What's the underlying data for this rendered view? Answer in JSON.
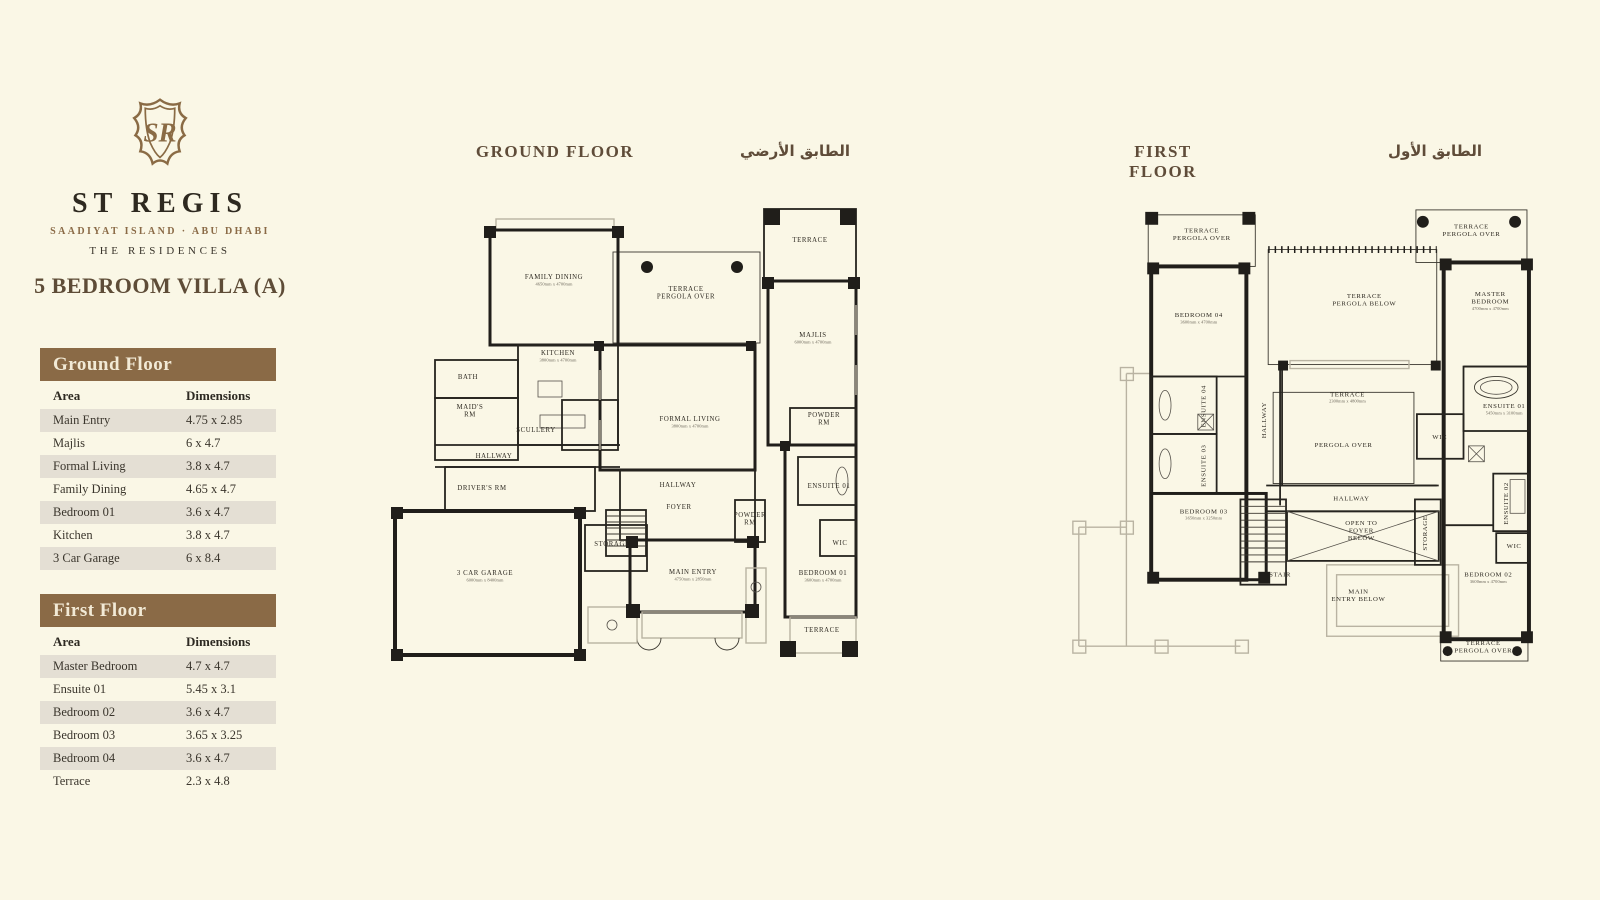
{
  "colors": {
    "background": "#faf7e6",
    "accent_brown": "#8a6a46",
    "row_alt": "#e4dfd4",
    "heading": "#5f4c39",
    "text": "#3a352c"
  },
  "brand": {
    "monogram": "SR",
    "name": "ST REGIS",
    "subtitle": "SAADIYAT ISLAND · ABU DHABI",
    "tagline": "THE RESIDENCES"
  },
  "title": "5 BEDROOM VILLA (A)",
  "tables": [
    {
      "title": "Ground Floor",
      "col1": "Area",
      "col2": "Dimensions",
      "rows": [
        [
          "Main Entry",
          "4.75 x 2.85"
        ],
        [
          "Majlis",
          "6 x 4.7"
        ],
        [
          "Formal Living",
          "3.8 x 4.7"
        ],
        [
          "Family Dining",
          "4.65 x 4.7"
        ],
        [
          "Bedroom 01",
          "3.6 x 4.7"
        ],
        [
          "Kitchen",
          "3.8 x 4.7"
        ],
        [
          "3 Car Garage",
          "6 x 8.4"
        ]
      ]
    },
    {
      "title": "First Floor",
      "col1": "Area",
      "col2": "Dimensions",
      "rows": [
        [
          "Master Bedroom",
          "4.7 x 4.7"
        ],
        [
          "Ensuite 01",
          "5.45 x 3.1"
        ],
        [
          "Bedroom 02",
          "3.6 x 4.7"
        ],
        [
          "Bedroom 03",
          "3.65 x 3.25"
        ],
        [
          "Bedroom 04",
          "3.6 x 4.7"
        ],
        [
          "Terrace",
          "2.3 x 4.8"
        ]
      ]
    }
  ],
  "plans": [
    {
      "heading_en": "GROUND FLOOR",
      "heading_ar": "الطابق الأرضي",
      "rooms": [
        {
          "x": 164,
          "y": 84,
          "l": [
            "FAMILY DINING"
          ],
          "s": "4650mm x 4700mm"
        },
        {
          "x": 296,
          "y": 96,
          "l": [
            "TERRACE",
            "PERGOLA OVER"
          ]
        },
        {
          "x": 168,
          "y": 160,
          "l": [
            "KITCHEN"
          ],
          "s": "3800mm x 4700mm"
        },
        {
          "x": 78,
          "y": 184,
          "l": [
            "BATH"
          ]
        },
        {
          "x": 80,
          "y": 214,
          "l": [
            "MAID'S",
            "RM"
          ]
        },
        {
          "x": 146,
          "y": 237,
          "l": [
            "SCULLERY"
          ]
        },
        {
          "x": 104,
          "y": 263,
          "l": [
            "HALLWAY"
          ]
        },
        {
          "x": 92,
          "y": 295,
          "l": [
            "DRIVER'S RM"
          ]
        },
        {
          "x": 95,
          "y": 380,
          "l": [
            "3 CAR GARAGE"
          ],
          "s": "6000mm x 8400mm"
        },
        {
          "x": 222,
          "y": 351,
          "l": [
            "STORAGE"
          ]
        },
        {
          "x": 420,
          "y": 47,
          "l": [
            "TERRACE"
          ]
        },
        {
          "x": 423,
          "y": 142,
          "l": [
            "MAJLIS"
          ],
          "s": "6000mm x 4700mm"
        },
        {
          "x": 434,
          "y": 222,
          "l": [
            "POWDER",
            "RM"
          ]
        },
        {
          "x": 288,
          "y": 292,
          "l": [
            "HALLWAY"
          ]
        },
        {
          "x": 289,
          "y": 314,
          "l": [
            "FOYER"
          ]
        },
        {
          "x": 360,
          "y": 322,
          "l": [
            "POWDER",
            "RM"
          ]
        },
        {
          "x": 439,
          "y": 293,
          "l": [
            "ENSUITE 01"
          ]
        },
        {
          "x": 450,
          "y": 350,
          "l": [
            "WIC"
          ]
        },
        {
          "x": 433,
          "y": 380,
          "l": [
            "BEDROOM 01"
          ],
          "s": "3600mm x 4700mm"
        },
        {
          "x": 303,
          "y": 379,
          "l": [
            "MAIN ENTRY"
          ],
          "s": "4750mm x 2850mm"
        },
        {
          "x": 432,
          "y": 437,
          "l": [
            "TERRACE"
          ]
        },
        {
          "x": 300,
          "y": 226,
          "l": [
            "FORMAL LIVING"
          ],
          "s": "3800mm x 4700mm"
        }
      ]
    },
    {
      "heading_en": "FIRST FLOOR",
      "heading_ar": "الطابق الأول",
      "rooms": [
        {
          "x": 161,
          "y": 35,
          "l": [
            "TERRACE",
            "PERGOLA OVER"
          ]
        },
        {
          "x": 158,
          "y": 120,
          "l": [
            "BEDROOM 04"
          ],
          "s": "3600mm x 4700mm"
        },
        {
          "x": 165,
          "y": 210,
          "l": [
            "ENSUITE 04"
          ],
          "r": -90
        },
        {
          "x": 165,
          "y": 270,
          "l": [
            "ENSUITE 03"
          ],
          "r": -90
        },
        {
          "x": 226,
          "y": 224,
          "l": [
            "HALLWAY"
          ],
          "r": -90
        },
        {
          "x": 163,
          "y": 318,
          "l": [
            "BEDROOM 03"
          ],
          "s": "3650mm x 3250mm"
        },
        {
          "x": 325,
          "y": 101,
          "l": [
            "TERRACE",
            "PERGOLA BELOW"
          ]
        },
        {
          "x": 308,
          "y": 200,
          "l": [
            "TERRACE"
          ],
          "s": "2300mm x 4800mm"
        },
        {
          "x": 304,
          "y": 251,
          "l": [
            "PERGOLA OVER"
          ]
        },
        {
          "x": 312,
          "y": 305,
          "l": [
            "HALLWAY"
          ]
        },
        {
          "x": 322,
          "y": 330,
          "l": [
            "OPEN TO",
            "FOYER",
            "BELOW"
          ]
        },
        {
          "x": 240,
          "y": 382,
          "l": [
            "STAIR"
          ]
        },
        {
          "x": 319,
          "y": 399,
          "l": [
            "MAIN",
            "ENTRY BELOW"
          ]
        },
        {
          "x": 388,
          "y": 338,
          "l": [
            "STORAGE"
          ],
          "r": -90
        },
        {
          "x": 433,
          "y": 31,
          "l": [
            "TERRACE",
            "PERGOLA OVER"
          ]
        },
        {
          "x": 452,
          "y": 99,
          "l": [
            "MASTER",
            "BEDROOM"
          ],
          "s": "4700mm x 4700mm"
        },
        {
          "x": 466,
          "y": 212,
          "l": [
            "ENSUITE 01"
          ],
          "s": "5450mm x 3100mm"
        },
        {
          "x": 401,
          "y": 243,
          "l": [
            "WIC"
          ]
        },
        {
          "x": 470,
          "y": 308,
          "l": [
            "ENSUITE 02"
          ],
          "r": -90
        },
        {
          "x": 476,
          "y": 353,
          "l": [
            "WIC"
          ]
        },
        {
          "x": 450,
          "y": 382,
          "l": [
            "BEDROOM 02"
          ],
          "s": "3600mm x 4700mm"
        },
        {
          "x": 445,
          "y": 451,
          "l": [
            "TERRACE",
            "PERGOLA OVER"
          ]
        }
      ]
    }
  ]
}
